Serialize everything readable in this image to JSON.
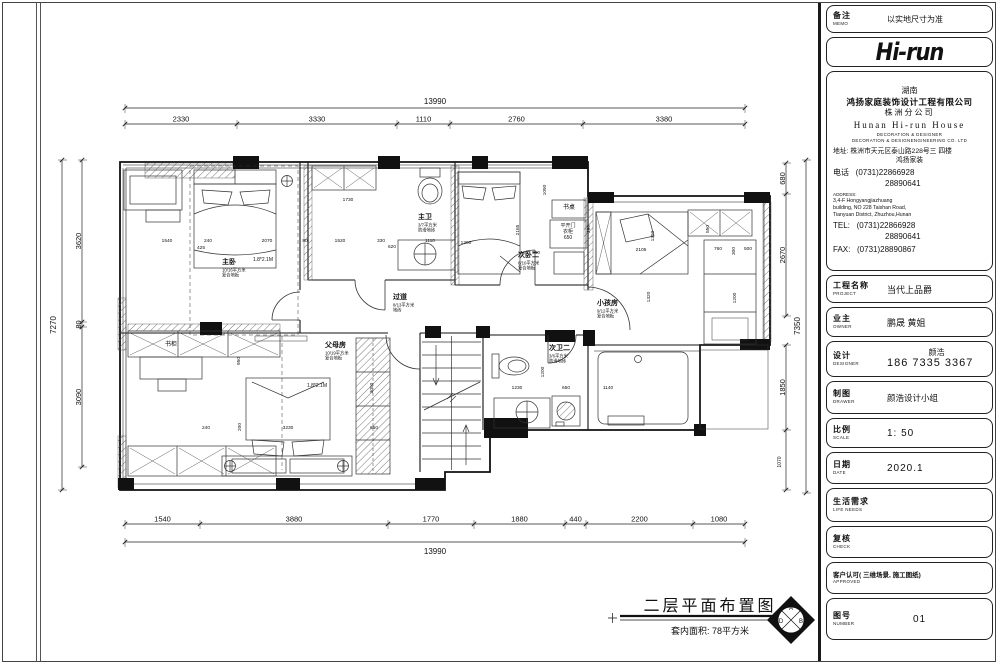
{
  "plan": {
    "title": "二层平面布置图",
    "area_note": "套内面积: 78平方米",
    "compass": {
      "top": "A",
      "right": "B",
      "bottom": "C",
      "left": "D"
    },
    "dims": {
      "top_total": "13990",
      "top": [
        "2330",
        "3330",
        "1110",
        "2760",
        "3380"
      ],
      "bottom": [
        "1540",
        "3880",
        "1770",
        "1880",
        "440",
        "2200",
        "1080"
      ],
      "bottom_total": "13990",
      "left_total": "7270",
      "left": [
        "3620",
        "80",
        "3090"
      ],
      "right_upper": [
        "680",
        "2670"
      ],
      "right_lower": [
        "1850",
        "1070"
      ],
      "right_total": "7350"
    },
    "rooms": [
      {
        "n": "主卧",
        "l1": "10/16平方米",
        "l2": "复合地板",
        "x": 222,
        "y": 264
      },
      {
        "n": "主卫",
        "l1": "3/7平方米",
        "l2": "防滑地砖",
        "x": 418,
        "y": 219
      },
      {
        "n": "过道",
        "l1": "8/13平方米",
        "l2": "地砖",
        "x": 393,
        "y": 299
      },
      {
        "n": "次卧二",
        "l1": "8/10平方米",
        "l2": "复合地板",
        "x": 518,
        "y": 257
      },
      {
        "n": "小孩房",
        "l1": "9/12平方米",
        "l2": "复合地板",
        "x": 597,
        "y": 305
      },
      {
        "n": "父母房",
        "l1": "10/19平方米",
        "l2": "复合地板",
        "x": 325,
        "y": 347
      },
      {
        "n": "次卫二",
        "l1": "3/6平方米",
        "l2": "防滑地砖",
        "x": 549,
        "y": 350
      }
    ],
    "labels": [
      {
        "t": "1.8*2.1M",
        "x": 263,
        "y": 261,
        "s": 5
      },
      {
        "t": "1.8*2.1M",
        "x": 317,
        "y": 387,
        "s": 5
      },
      {
        "t": "书桌",
        "x": 569,
        "y": 209,
        "s": 6
      },
      {
        "t": "平开门",
        "x": 568,
        "y": 227,
        "s": 5
      },
      {
        "t": "衣柜",
        "x": 568,
        "y": 233,
        "s": 5
      },
      {
        "t": "650",
        "x": 568,
        "y": 239,
        "s": 5
      },
      {
        "t": "书柜",
        "x": 171,
        "y": 346,
        "s": 6
      }
    ],
    "interior_dims": [
      {
        "t": "1540",
        "x": 167,
        "y": 242
      },
      {
        "t": "425",
        "x": 201,
        "y": 249
      },
      {
        "t": "240",
        "x": 208,
        "y": 242
      },
      {
        "t": "2070",
        "x": 267,
        "y": 242
      },
      {
        "t": "80",
        "x": 305,
        "y": 242
      },
      {
        "t": "1520",
        "x": 340,
        "y": 242
      },
      {
        "t": "330",
        "x": 381,
        "y": 242
      },
      {
        "t": "620",
        "x": 392,
        "y": 248
      },
      {
        "t": "1110",
        "x": 430,
        "y": 242
      },
      {
        "t": "1200",
        "x": 466,
        "y": 244
      },
      {
        "t": "1730",
        "x": 348,
        "y": 201
      },
      {
        "t": "2165",
        "x": 519,
        "y": 230,
        "r": 1
      },
      {
        "t": "1090",
        "x": 546,
        "y": 190,
        "r": 1
      },
      {
        "t": "950",
        "x": 536,
        "y": 254
      },
      {
        "t": "290",
        "x": 590,
        "y": 229,
        "r": 1
      },
      {
        "t": "2105",
        "x": 641,
        "y": 251
      },
      {
        "t": "1350",
        "x": 654,
        "y": 236,
        "r": 1
      },
      {
        "t": "550",
        "x": 709,
        "y": 229,
        "r": 1
      },
      {
        "t": "760",
        "x": 718,
        "y": 250
      },
      {
        "t": "300",
        "x": 735,
        "y": 251,
        "r": 1
      },
      {
        "t": "500",
        "x": 748,
        "y": 250
      },
      {
        "t": "1320",
        "x": 650,
        "y": 297,
        "r": 1
      },
      {
        "t": "1200",
        "x": 736,
        "y": 298,
        "r": 1
      },
      {
        "t": "950",
        "x": 240,
        "y": 361,
        "r": 1
      },
      {
        "t": "240",
        "x": 206,
        "y": 429
      },
      {
        "t": "200",
        "x": 241,
        "y": 427,
        "r": 1
      },
      {
        "t": "3230",
        "x": 288,
        "y": 429
      },
      {
        "t": "650",
        "x": 374,
        "y": 429
      },
      {
        "t": "3050",
        "x": 373,
        "y": 388,
        "r": 1
      },
      {
        "t": "1230",
        "x": 517,
        "y": 389
      },
      {
        "t": "650",
        "x": 566,
        "y": 389
      },
      {
        "t": "1140",
        "x": 608,
        "y": 389
      },
      {
        "t": "1200",
        "x": 544,
        "y": 372,
        "r": 1
      }
    ]
  },
  "titleblock": {
    "memo": {
      "label": "备注",
      "sublabel": "MEMO",
      "value": "以实地尺寸为准"
    },
    "logo": "Hi-run",
    "company": {
      "region": "湖南",
      "name": "鸿扬家庭装饰设计工程有限公司",
      "branch": "株洲分公司",
      "en_name": "Hunan  Hi-run  House",
      "en_line1": "DECORATION & DESIGNER",
      "en_line2": "DECORATION & DESIGNENGINEERING CO. LTD",
      "addr_label": "地址:",
      "addr": "株洲市天元区泰山路228号三 四楼",
      "addr2": "鸿扬家装",
      "phone_label": "电话",
      "phone1": "(0731)22866928",
      "phone2": "28890641",
      "address_label": "ADDRESS:",
      "address_en": [
        "3,4-F Hongyangjiazhuang",
        "building, NO 228 Taishan Road,",
        "Tianyuan District, Zhuzhou,Hunan"
      ],
      "tel_label": "TEL:",
      "tel1": "(0731)22866928",
      "tel2": "28890641",
      "fax_label": "FAX:",
      "fax": "(0731)28890867"
    },
    "project": {
      "label": "工程名称",
      "sublabel": "PROJECT",
      "value": "当代上品爵"
    },
    "owner": {
      "label": "业主",
      "sublabel": "OWNER",
      "value": "鹏晟  黄姐"
    },
    "designer": {
      "label": "设计",
      "sublabel": "DESIGNER",
      "value": "颜浩",
      "phone": "186  7335  3367"
    },
    "drawer": {
      "label": "制图",
      "sublabel": "DRAWER",
      "value": "颜浩设计小组"
    },
    "scale": {
      "label": "比例",
      "sublabel": "SCALE",
      "value": "1: 50"
    },
    "date": {
      "label": "日期",
      "sublabel": "DATE",
      "value": "2020.1"
    },
    "life": {
      "label": "生活需求",
      "sublabel": "LIFE  NEEDS",
      "value": ""
    },
    "check": {
      "label": "复核",
      "sublabel": "CHECK",
      "value": ""
    },
    "approved": {
      "label": "客户认可( 三维场景, 施工图纸)",
      "sublabel": "APPROVED",
      "value": ""
    },
    "number": {
      "label": "图号",
      "sublabel": "NUMBER",
      "value": "01"
    }
  }
}
